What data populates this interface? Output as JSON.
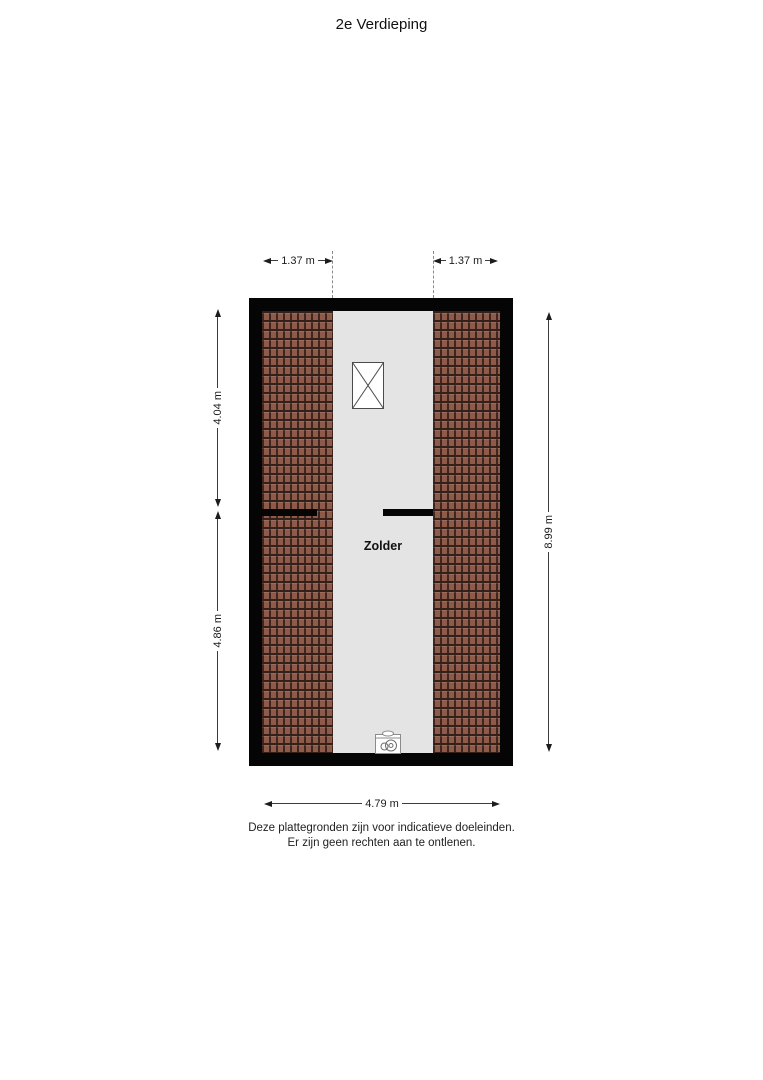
{
  "title": "2e Verdieping",
  "floorplan": {
    "room_label": "Zolder",
    "fixtures": [
      "window-icon",
      "boiler-icon"
    ],
    "colors": {
      "wall": "#050505",
      "roof_tile": "#8e5b4a",
      "roof_tile_line": "#40251f",
      "floor": "#e4e4e4"
    }
  },
  "dimensions": {
    "top_left": "1.37 m",
    "top_right": "1.37 m",
    "left_upper": "4.04 m",
    "left_lower": "4.86 m",
    "right": "8.99 m",
    "bottom": "4.79 m"
  },
  "disclaimer": {
    "line1": "Deze plattegronden zijn voor indicatieve doeleinden.",
    "line2": "Er zijn geen rechten aan te ontlenen."
  }
}
